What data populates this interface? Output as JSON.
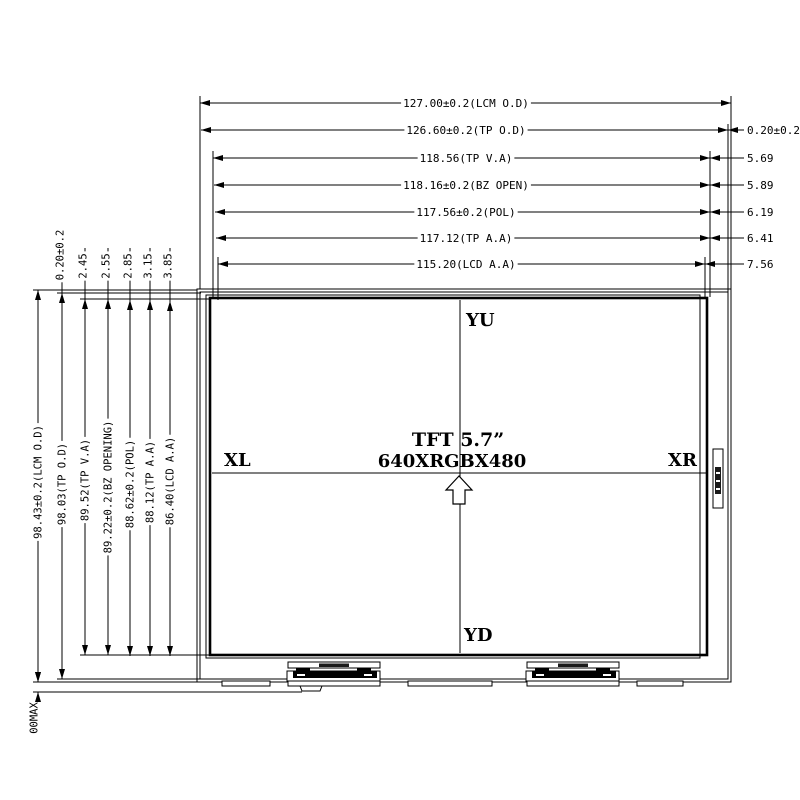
{
  "top_dimensions": [
    "127.00±0.2(LCM O.D)",
    "126.60±0.2(TP O.D)",
    "118.56(TP V.A)",
    "118.16±0.2(BZ OPEN)",
    "117.56±0.2(POL)",
    "117.12(TP A.A)",
    "115.20(LCD A.A)"
  ],
  "right_offsets": [
    "0.20±0.2",
    "5.69",
    "5.89",
    "6.19",
    "6.41",
    "7.56"
  ],
  "left_dimensions": [
    "98.43±0.2(LCM O.D)",
    "98.03(TP O.D)",
    "89.52(TP V.A)",
    "89.22±0.2(BZ OPENING)",
    "88.62±0.2(POL)",
    "88.12(TP A.A)",
    "86.40(LCD A.A)"
  ],
  "top_offsets": [
    "0.20±0.2",
    "2.45",
    "2.55",
    "2.85",
    "3.15",
    "3.85"
  ],
  "bottom_note": "00MAX",
  "display": {
    "top_pin": "YU",
    "bottom_pin": "YD",
    "left_pin": "XL",
    "right_pin": "XR",
    "size_label": "TFT 5.7”",
    "resolution_label": "640XRGBX480"
  },
  "colors": {
    "line": "#000000",
    "background": "#ffffff"
  }
}
